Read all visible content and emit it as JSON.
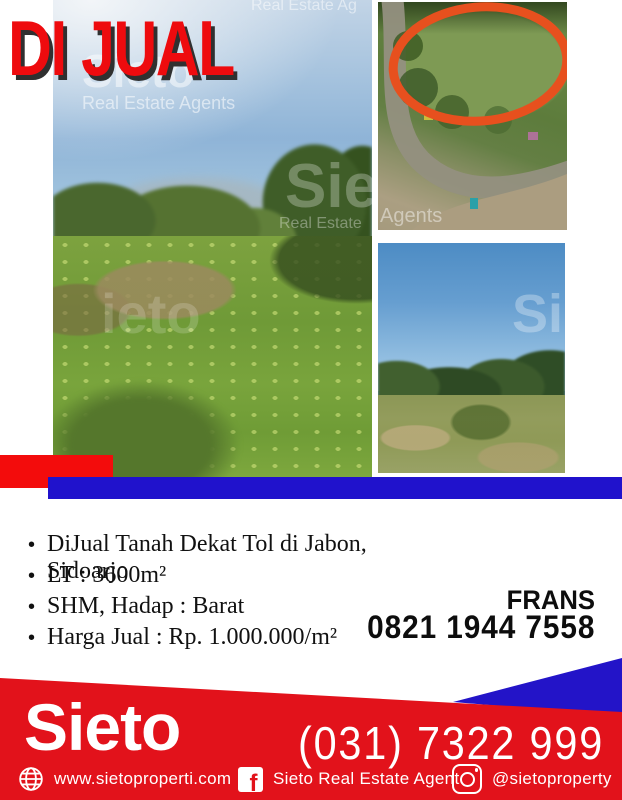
{
  "badge": {
    "label": "DI JUAL"
  },
  "watermarks": {
    "left_top_brand": "Sieto",
    "left_top_sub": "Real Estate Agents",
    "left_topright": "Real Estate Ag",
    "left_mid_brand": "ieto",
    "left_right_brand": "Sie",
    "left_right_sub": "Real Estate",
    "aerial_bottom": "Agents",
    "field_mid": "Si"
  },
  "listing": {
    "bullet_char": "•",
    "bullets": [
      "DiJual Tanah Dekat Tol di Jabon, Sidoarjo",
      "LT : 3600m²",
      "SHM, Hadap : Barat",
      "Harga Jual : Rp. 1.000.000/m²"
    ],
    "agent_name": "FRANS",
    "agent_phone": "0821 1944 7558"
  },
  "footer": {
    "brand": "Sieto",
    "phone": "(031) 7322 999",
    "website_label": "www.sietoproperti.com",
    "facebook_label": "Sieto Real Estate Agent",
    "instagram_label": "@sietoproperty",
    "facebook_glyph": "f"
  },
  "icons": {
    "website": "globe-icon",
    "facebook": "facebook-icon",
    "instagram": "instagram-icon"
  },
  "colors": {
    "badge_red": "#ee0b0e",
    "badge_shadow": "#303030",
    "divider_red": "#f30c0c",
    "divider_blue": "#2012cc",
    "footer_red": "#e2121b",
    "footer_blue": "#2314c8",
    "highlight_oval": "#e7501e"
  }
}
